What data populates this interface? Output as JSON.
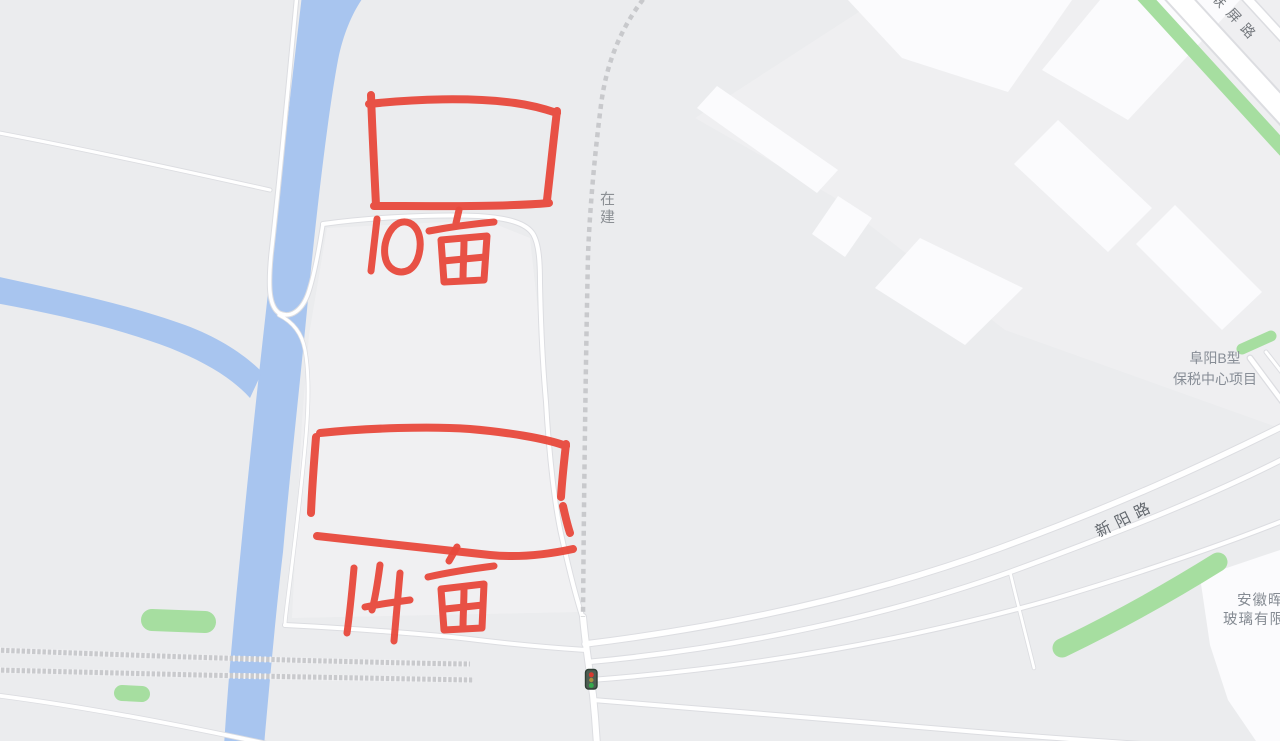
{
  "colors": {
    "background": "#ebecee",
    "water": "#a8c5ef",
    "greenery": "#a6dea0",
    "road-fill": "#ffffff",
    "road-casing": "#dcdde1",
    "building": "#fbfbfd",
    "parcel-light": "#f1f1f3",
    "railway": "#c9cacd",
    "dashed-road": "#c8c9cc",
    "annotation-red": "#e8493c",
    "label-grey": "#878d96",
    "road-label-dark": "#62676d"
  },
  "labels": {
    "under_construction": "在建",
    "road_top_right": "联屏路",
    "road_xinyang": "新阳路",
    "project_line1": "阜阳B型",
    "project_line2": "保税中心项目",
    "company_line1": "安徽晖",
    "company_line2": "玻璃有限"
  },
  "annotations": {
    "parcel_top": "10亩",
    "parcel_bottom": "14亩"
  },
  "icons": {
    "traffic_light": "traffic-light"
  }
}
